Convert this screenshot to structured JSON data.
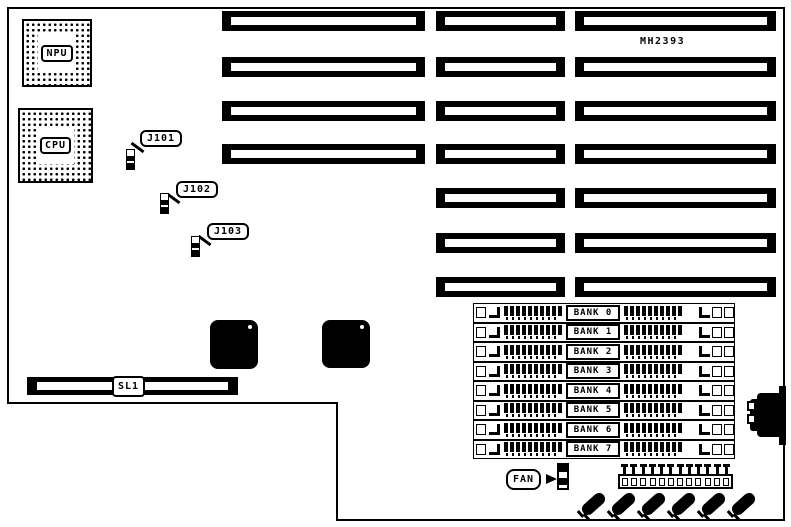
{
  "diagram": {
    "part_number": "MH2393",
    "chips": {
      "npu": "NPU",
      "cpu": "CPU"
    },
    "jumpers": [
      "J101",
      "J102",
      "J103"
    ],
    "fan_label": "FAN",
    "slot1_label": "SL1",
    "banks": [
      "BANK 0",
      "BANK 1",
      "BANK 2",
      "BANK 3",
      "BANK 4",
      "BANK 5",
      "BANK 6",
      "BANK 7"
    ],
    "structure": {
      "expansion_slot_columns": [
        {
          "slots": 4
        },
        {
          "slots": 7
        },
        {
          "slots": 7
        }
      ],
      "memory_bank_count": 8,
      "diagonal_component_count": 6
    },
    "colors": {
      "ink": "#000000",
      "board": "#ffffff"
    }
  }
}
